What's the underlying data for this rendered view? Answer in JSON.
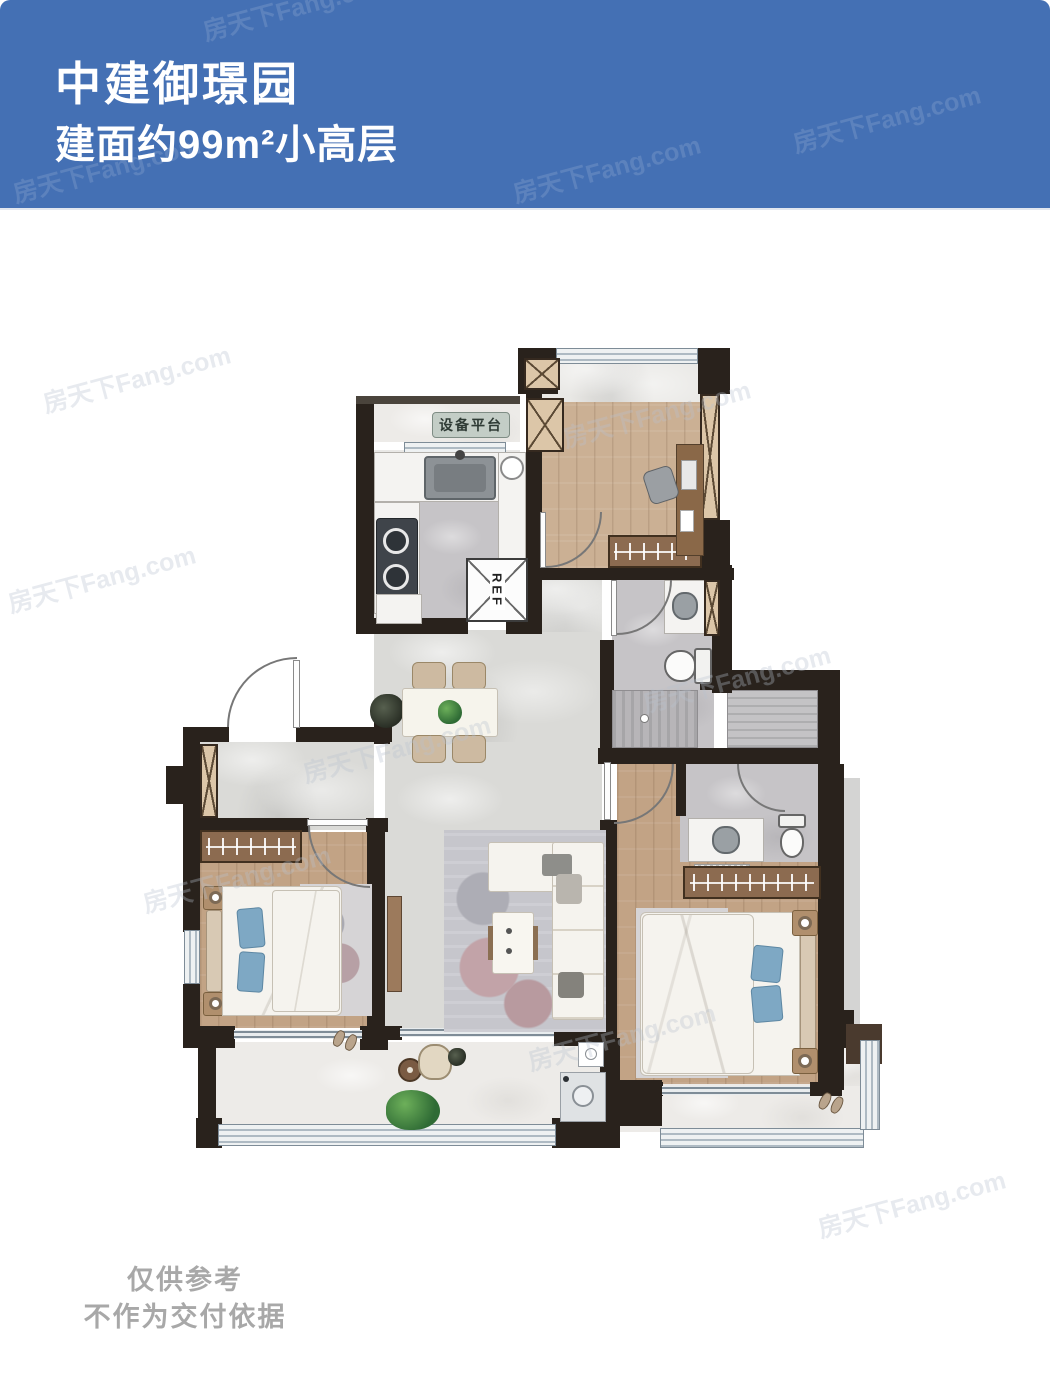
{
  "header": {
    "title": "中建御璟园",
    "subtitle": "建面约99m²小高层",
    "bg_color": "#4470b4"
  },
  "watermark": {
    "text": "房天下Fang.com",
    "color": "#b9c2cf"
  },
  "plan": {
    "labels": {
      "equipment_platform": "设备平台",
      "fridge": "REF"
    },
    "colors": {
      "wall": "#29221c",
      "wood": "#c2a385",
      "marble": "#dadad7",
      "bath": "#c6c4c7",
      "stone": "#edebe8",
      "counter": "#f4f3f1",
      "wardrobe": "#8c6b50",
      "rug": "#c6c6cc",
      "sofa": "#f5f3ee",
      "pillow": "#7ea8c4",
      "window": "#eef1f2",
      "frame": "#7e8c97"
    }
  },
  "footer": {
    "line1": "仅供参考",
    "line2": "不作为交付依据",
    "color": "#a8a8a8"
  }
}
